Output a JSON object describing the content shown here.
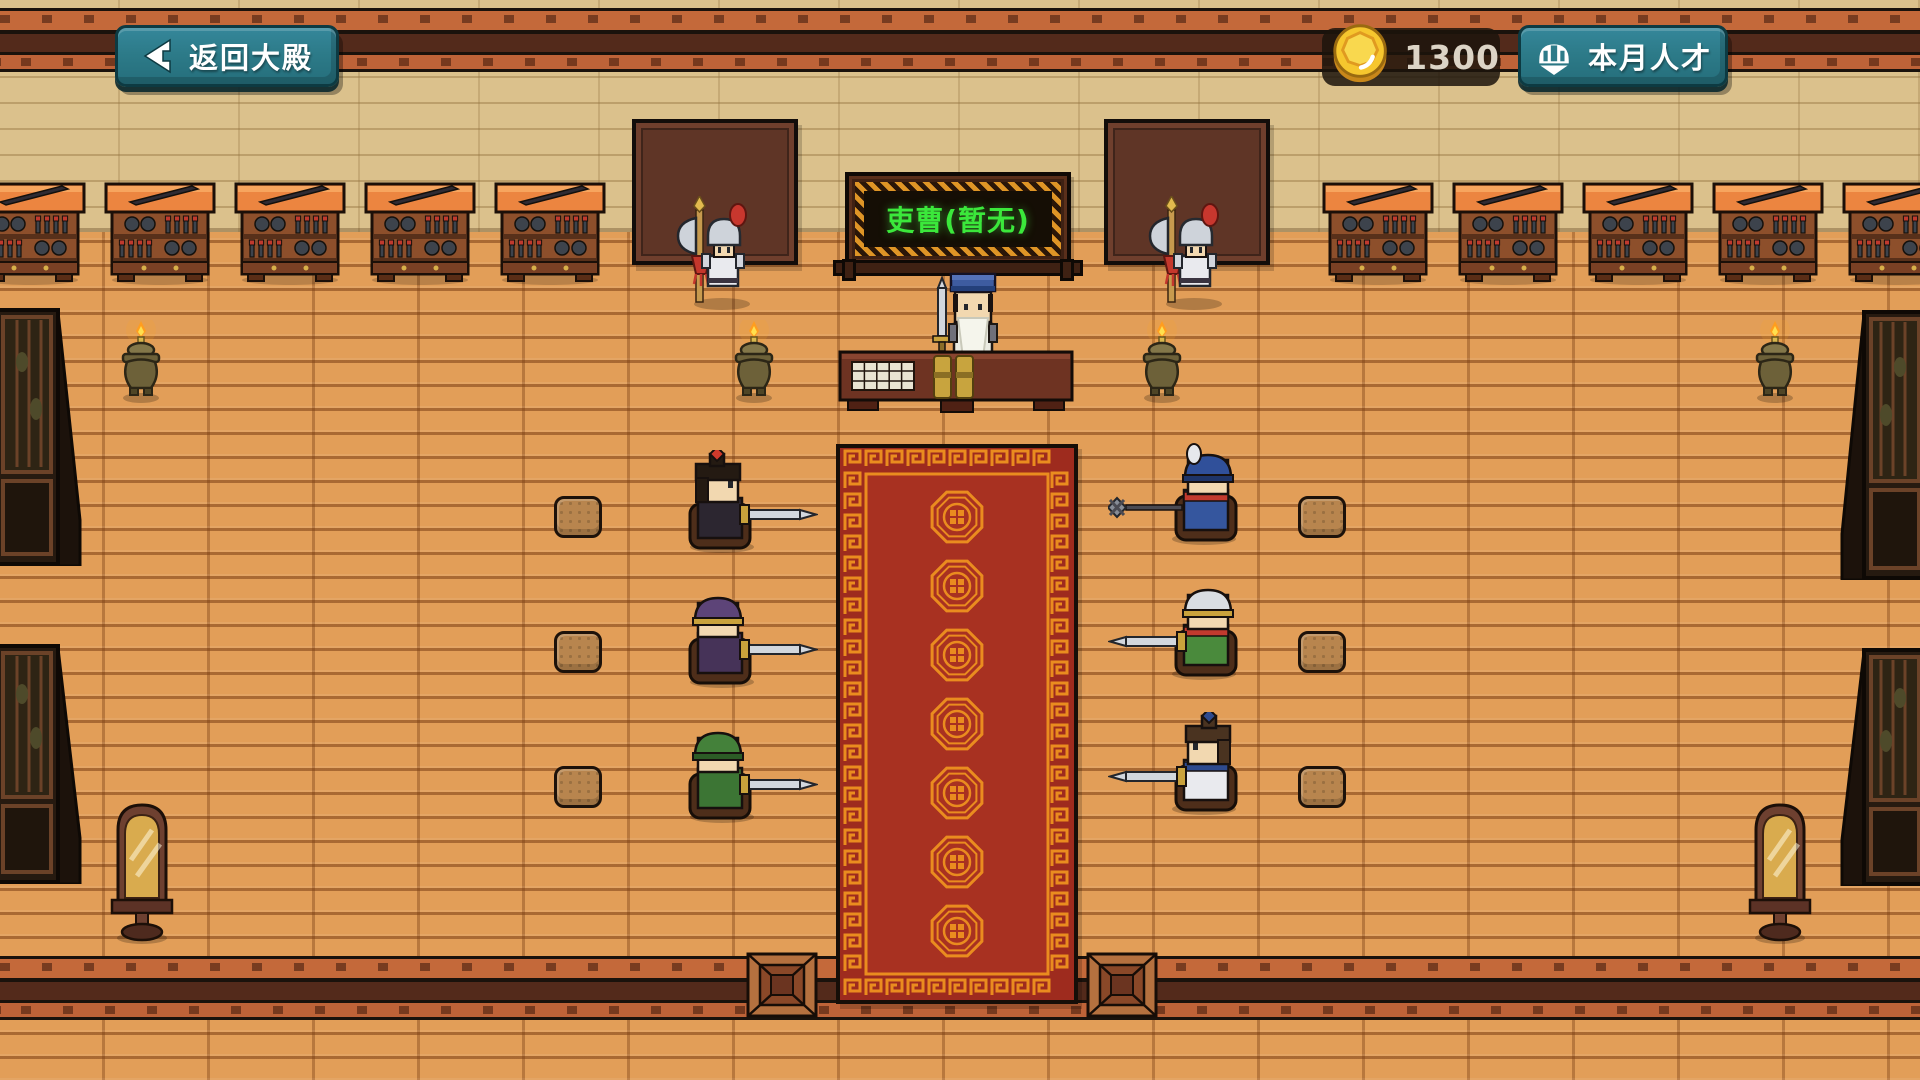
{
  "hud": {
    "back_button": {
      "label": "返回大殿",
      "icon": "arrow-left-icon"
    },
    "coins": {
      "value": "1300",
      "icon": "coin-icon",
      "coin_color": "#f6c62e"
    },
    "talent_button": {
      "label": "本月人才",
      "icon": "helmet-icon"
    },
    "button_color": "#2d7b89"
  },
  "scene": {
    "plaque": {
      "text": "吏曹(暂无)",
      "text_color": "#3be83b",
      "gold": "#df9526",
      "x": 845,
      "y": 172
    },
    "palette": {
      "floor": "#e29e58",
      "wall": "#dbc18c",
      "beam_light": "#c4693a",
      "beam_dark": "#532a1b",
      "carpet_red": "#9e2b1e",
      "carpet_gold": "#ea8c1f",
      "rack_top": "#ec8540",
      "wood_dark": "#5f3526"
    },
    "beams": {
      "top_y": 8,
      "bottom_y": 956
    },
    "boards": [
      {
        "x": 632,
        "y": 119
      },
      {
        "x": 1104,
        "y": 119
      }
    ],
    "racks": {
      "y": 176,
      "xs": [
        -26,
        104,
        234,
        364,
        494,
        1322,
        1452,
        1582,
        1712,
        1842
      ]
    },
    "guards": [
      {
        "x": 676,
        "y": 196
      },
      {
        "x": 1148,
        "y": 196
      }
    ],
    "official": {
      "x": 928,
      "y": 266,
      "hat": "#3e5ca0",
      "beard": "#f5f5ec",
      "body": "#ebebe2"
    },
    "desk": {
      "x": 838,
      "y": 346
    },
    "burners": {
      "y": 320,
      "xs": [
        118,
        731,
        1139,
        1752
      ]
    },
    "screens": [
      {
        "x": -6,
        "y": 308,
        "h": 258,
        "side": "left"
      },
      {
        "x": -6,
        "y": 644,
        "h": 240,
        "side": "left"
      },
      {
        "x": 1840,
        "y": 310,
        "h": 270,
        "side": "right"
      },
      {
        "x": 1840,
        "y": 648,
        "h": 238,
        "side": "right"
      }
    ],
    "mirrors": [
      {
        "x": 106,
        "y": 786
      },
      {
        "x": 1744,
        "y": 786
      }
    ],
    "carpet": {
      "x": 836,
      "y": 444,
      "w": 242,
      "h": 560,
      "medallions": 7
    },
    "mats": [
      {
        "x": 746,
        "y": 952
      },
      {
        "x": 1086,
        "y": 952
      }
    ],
    "cushions": [
      {
        "x": 554,
        "y": 496
      },
      {
        "x": 554,
        "y": 631
      },
      {
        "x": 554,
        "y": 766
      },
      {
        "x": 1298,
        "y": 496
      },
      {
        "x": 1298,
        "y": 631
      },
      {
        "x": 1298,
        "y": 766
      }
    ],
    "seated": [
      {
        "x": 668,
        "y": 450,
        "flip": false,
        "head": "bun",
        "hair": "#241a12",
        "orn": "#cf3a2c",
        "body": "#2c2630",
        "skin": "#f2d8b0",
        "weapon": "sword"
      },
      {
        "x": 668,
        "y": 585,
        "flip": false,
        "head": "helm",
        "hat": "#5d4478",
        "trim": "#c9a23c",
        "body": "#463358",
        "skin": "#f2d8b0",
        "weapon": "sword"
      },
      {
        "x": 668,
        "y": 720,
        "flip": false,
        "head": "helm",
        "hat": "#44813a",
        "trim": "#2c5c26",
        "body": "#3c7534",
        "skin": "#f2d8b0",
        "weapon": "sword"
      },
      {
        "x": 1108,
        "y": 442,
        "flip": true,
        "head": "helm",
        "hat": "#30509a",
        "trim": "#1e3468",
        "plume": "#e6e8ec",
        "body": "#35569e",
        "scarf": "#c23a2e",
        "skin": "#f2d8b0",
        "weapon": "spear"
      },
      {
        "x": 1108,
        "y": 577,
        "flip": true,
        "head": "helm",
        "hat": "#d9dde2",
        "trim": "#c9a23c",
        "body": "#4a8a3c",
        "scarf": "#c23a2e",
        "skin": "#f2d8b0",
        "weapon": "sword"
      },
      {
        "x": 1108,
        "y": 712,
        "flip": true,
        "head": "bun",
        "hair": "#4a3320",
        "orn": "#2e4a8e",
        "body": "#e9eaee",
        "scarf": "#2e4a8e",
        "skin": "#f2d8b0",
        "weapon": "sword"
      }
    ]
  }
}
